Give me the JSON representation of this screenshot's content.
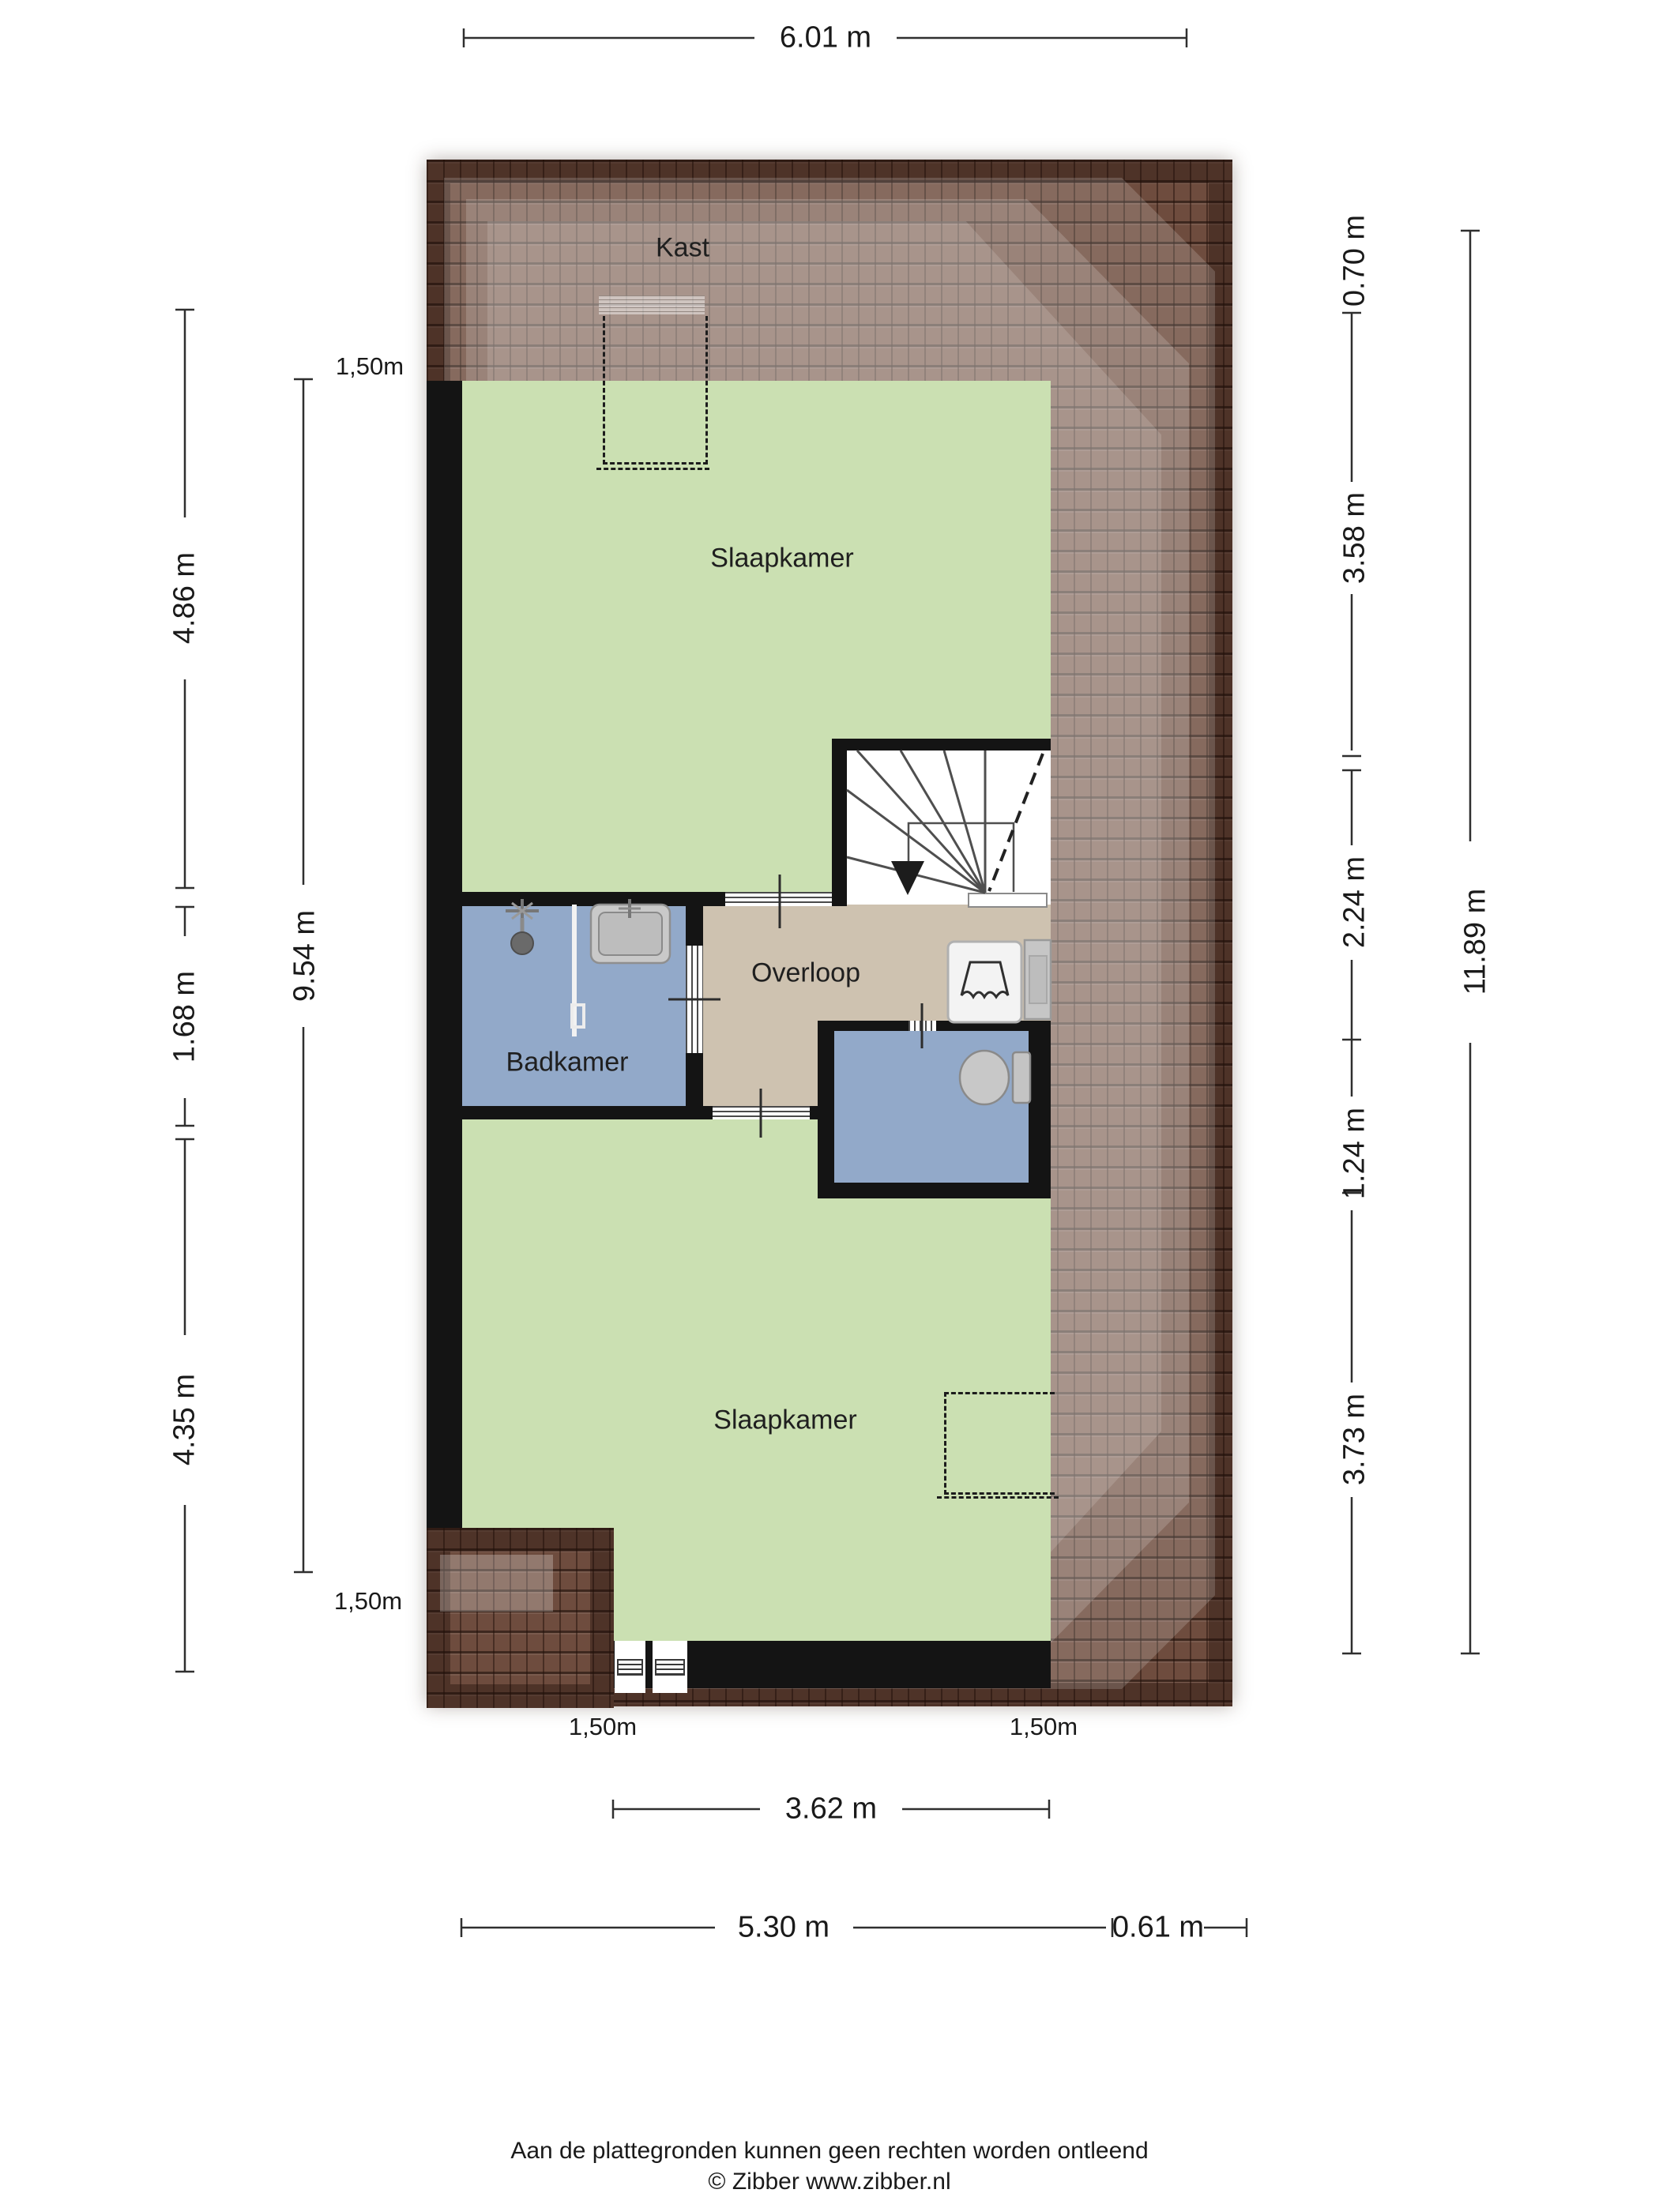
{
  "plan": {
    "rooms": {
      "kast": "Kast",
      "bedroom_top": "Slaapkamer",
      "landing": "Overloop",
      "bathroom": "Badkamer",
      "bedroom_bottom": "Slaapkamer"
    },
    "dimensions": {
      "top_width": "6.01 m",
      "left": {
        "knee_top": "1,50m",
        "seg1": "4.86 m",
        "inner_total": "9.54 m",
        "seg2": "1.68 m",
        "seg3": "4.35 m",
        "knee_bottom": "1,50m"
      },
      "right": {
        "seg1": "0.70 m",
        "seg2": "3.58 m",
        "seg3": "2.24 m",
        "seg4": "1.24 m",
        "seg5": "3.73 m",
        "outer_total": "11.89 m"
      },
      "bottom": {
        "knee_left": "1,50m",
        "knee_right": "1,50m",
        "inner_width": "3.62 m",
        "main_width": "5.30 m",
        "right_width": "0.61 m"
      }
    },
    "colors": {
      "roof_tile": "#6e4c3e",
      "room_green": "#cbe0b2",
      "wet_blue": "#92a9c9",
      "hall_tan": "#cec2b0",
      "wall": "#141414",
      "fixture_gray": "#c6c6c6",
      "dim_line": "#2f2f2f"
    }
  },
  "footer": {
    "disclaimer": "Aan de plattegronden kunnen geen rechten worden ontleend",
    "credit": "© Zibber www.zibber.nl"
  }
}
